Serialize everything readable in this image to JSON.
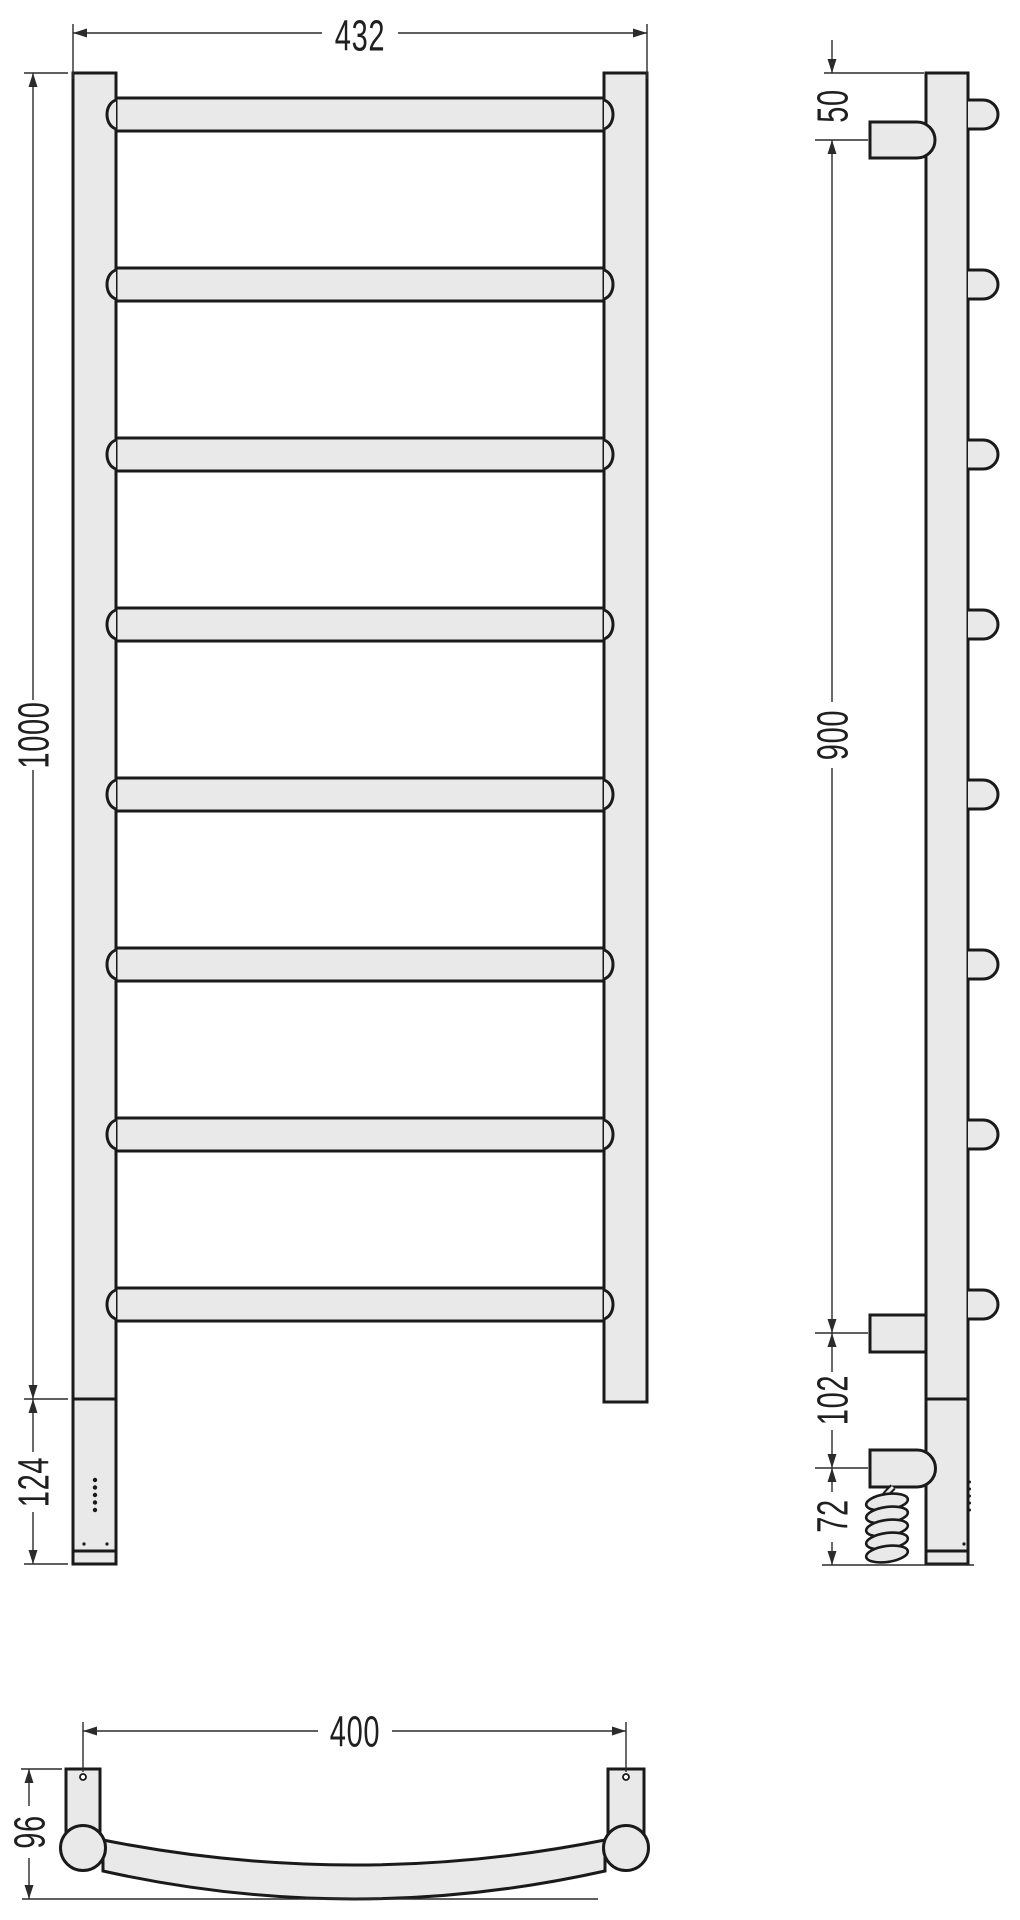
{
  "drawing": {
    "title": "Ladder heated towel rail - technical drawing, three views",
    "views": {
      "front": {
        "label": "front-view",
        "rung_count": 8,
        "dims": {
          "width": "432",
          "height": "1000",
          "lower_section": "124"
        }
      },
      "side": {
        "label": "side-view",
        "dims": {
          "top_to_upper_bracket": "50",
          "bracket_to_bracket": "900",
          "bracket_to_heater": "102",
          "heater_to_bottom": "72"
        }
      },
      "bottom": {
        "label": "bottom-view",
        "dims": {
          "mount_spacing": "400",
          "depth": "96"
        }
      }
    },
    "colors": {
      "part_fill": "#e9e9e9",
      "outline": "#1a1a1a",
      "dimension_line": "#2b2b2b"
    }
  }
}
